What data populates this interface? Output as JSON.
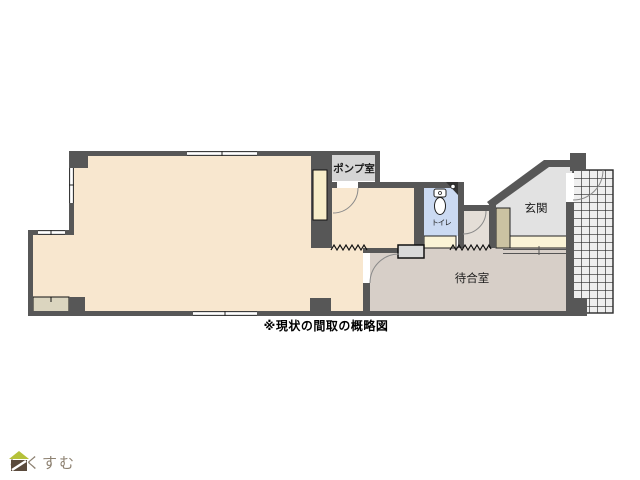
{
  "caption": "※現状の間取の概略図",
  "rooms": {
    "pump": {
      "label": "ポンプ室"
    },
    "entrance": {
      "label": "玄関"
    },
    "waiting": {
      "label": "待合室"
    },
    "toilet": {
      "label": "トイレ"
    }
  },
  "logo": {
    "text": "らくすむ",
    "icon": "house-icon"
  },
  "colors": {
    "wall": "#575757",
    "main_room_floor": "#f8e7cf",
    "waiting_room_floor": "#d7cfc8",
    "vestibule_floor": "#e4ded7",
    "entrance_floor": "#e2e2e2",
    "toilet_floor": "#cbdaf2",
    "step_strip": "#faf3d6",
    "closet_inset": "#f7edc9",
    "shoe_cabinet": "#cbc2a2",
    "pump_label_bg": "#d5d5d5",
    "counter_box": "#d9d9d9",
    "porch_tile_bg": "#efefef",
    "logo_roof_green": "#b5c13a",
    "logo_body_brown": "#5a4a3c",
    "logo_text": "#8d8171"
  }
}
